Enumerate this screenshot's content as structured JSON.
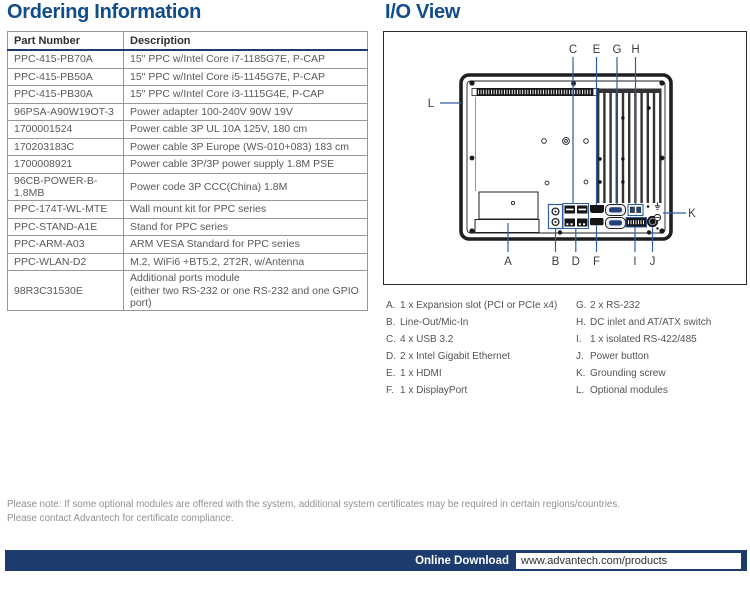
{
  "page": {
    "left_heading": "Ordering Information",
    "right_heading": "I/O View",
    "note_line1": "Please note: If some optional modules are offered with the system, additional system certificates may be required in certain regions/countries.",
    "note_line2": "Please contact Advantech for certificate compliance.",
    "footer": {
      "label": "Online Download",
      "url": "www.advantech.com/products"
    }
  },
  "colors": {
    "heading_blue": "#114d8a",
    "navy": "#1d3c6e",
    "callout_blue": "#2e5fa5",
    "border_gray": "#96989b"
  },
  "ordering_table": {
    "headers": {
      "part": "Part Number",
      "desc": "Description"
    },
    "rows": [
      {
        "part": "PPC-415-PB70A",
        "desc": "15\" PPC w/Intel Core i7-1185G7E, P-CAP"
      },
      {
        "part": "PPC-415-PB50A",
        "desc": "15\" PPC w/Intel Core i5-1145G7E, P-CAP"
      },
      {
        "part": "PPC-415-PB30A",
        "desc": "15\" PPC w/Intel Core i3-1115G4E, P-CAP"
      },
      {
        "part": "96PSA-A90W19OT-3",
        "desc": "Power adapter 100-240V 90W 19V"
      },
      {
        "part": "1700001524",
        "desc": "Power cable 3P UL 10A 125V, 180 cm"
      },
      {
        "part": "170203183C",
        "desc": "Power cable 3P Europe (WS-010+083) 183 cm"
      },
      {
        "part": "1700008921",
        "desc": "Power cable 3P/3P power supply 1.8M PSE"
      },
      {
        "part": "96CB-POWER-B-1.8MB",
        "desc": "Power code 3P CCC(China) 1.8M"
      },
      {
        "part": "PPC-174T-WL-MTE",
        "desc": "Wall mount kit for PPC series"
      },
      {
        "part": "PPC-STAND-A1E",
        "desc": "Stand for PPC series"
      },
      {
        "part": "PPC-ARM-A03",
        "desc": "ARM VESA Standard for PPC series"
      },
      {
        "part": "PPC-WLAN-D2",
        "desc": "M.2, WiFi6 +BT5.2, 2T2R, w/Antenna"
      },
      {
        "part": "98R3C31530E",
        "desc": "Additional ports module\n(either two RS-232 or one RS-232 and one GPIO port)"
      }
    ]
  },
  "io_view": {
    "callouts": {
      "top": [
        "C",
        "E",
        "G",
        "H"
      ],
      "bottom": [
        "A",
        "B",
        "D",
        "F",
        "I",
        "J"
      ],
      "left": "L",
      "right": "K"
    },
    "legend_left": [
      {
        "k": "A.",
        "v": "1 x Expansion slot (PCI or PCIe x4)"
      },
      {
        "k": "B.",
        "v": "Line-Out/Mic-In"
      },
      {
        "k": "C.",
        "v": "4 x USB 3.2"
      },
      {
        "k": "D.",
        "v": "2 x Intel Gigabit Ethernet"
      },
      {
        "k": "E.",
        "v": "1 x HDMI"
      },
      {
        "k": "F.",
        "v": "1 x DisplayPort"
      }
    ],
    "legend_right": [
      {
        "k": "G.",
        "v": "2 x RS-232"
      },
      {
        "k": "H.",
        "v": "DC inlet and AT/ATX switch"
      },
      {
        "k": "I.",
        "v": "1 x isolated RS-422/485"
      },
      {
        "k": "J.",
        "v": "Power button"
      },
      {
        "k": "K.",
        "v": "Grounding screw"
      },
      {
        "k": "L.",
        "v": "Optional modules"
      }
    ]
  }
}
